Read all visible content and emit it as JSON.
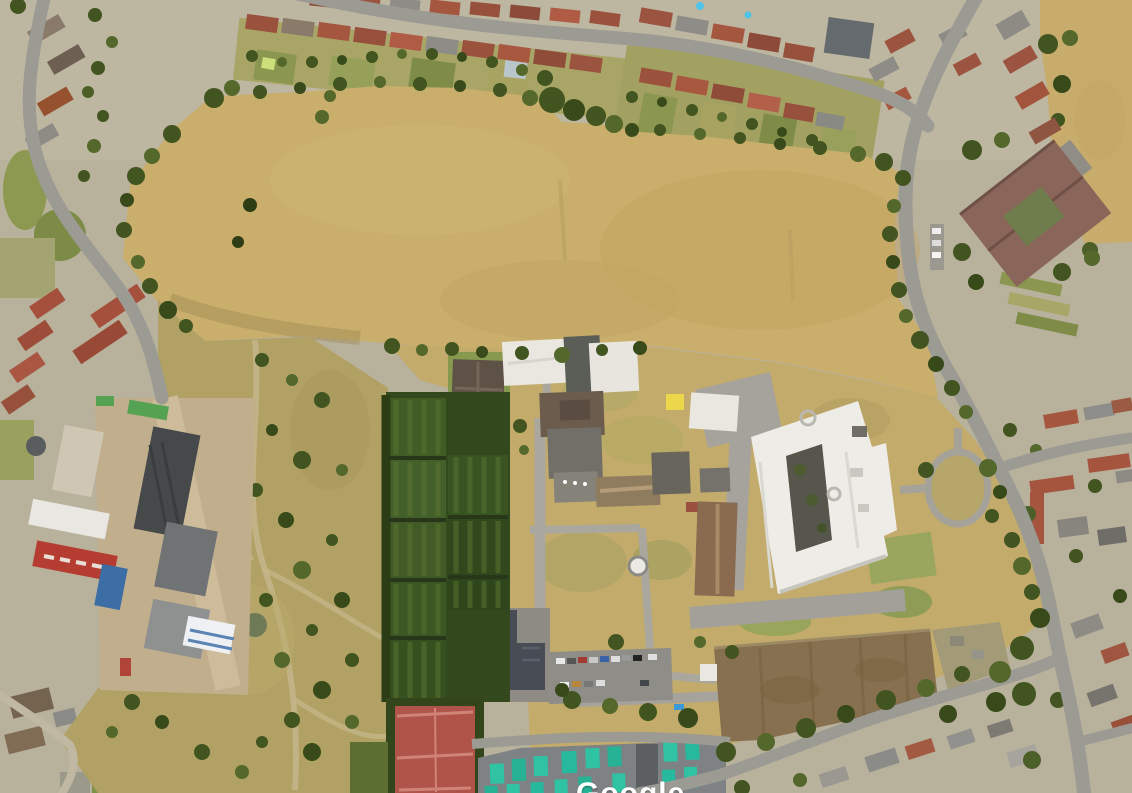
{
  "view": {
    "type": "satellite-aerial-3d",
    "watermark": "Google"
  },
  "palette": {
    "urban_base": "#b8b19c",
    "dry_field": "#c9ae6c",
    "dry_field_edge": "#b49a58",
    "northeast_field": "#c7ac6c",
    "scrub": "#b1a164",
    "campus_ground": "#c3ab6b",
    "road": "#9b9a93",
    "path": "#c6b88d",
    "tree": "#42541f",
    "tree_light": "#55682c",
    "hedge": "#2c3d15",
    "white_roof": "#edece6",
    "gray_roof": "#6f7374",
    "dark_roof": "#474c55",
    "red_roof": "#a5543e",
    "brown_roof": "#8a6b50",
    "quad_roof": "#8a665a",
    "allotment": "#33491d",
    "allotment_stripe": "#5c7631",
    "court_red": "#b0544a",
    "court_line": "#d08377",
    "stall_teal": "#2fc3a4",
    "stall_base": "#7e8284",
    "pool_blue": "#3fa3d8",
    "paddock": "#87704f",
    "industrial_red": "#b53c30",
    "industrial_blue": "#3d6da5",
    "yard": "#c0ae8d",
    "watermark_color": "#ffffff"
  }
}
